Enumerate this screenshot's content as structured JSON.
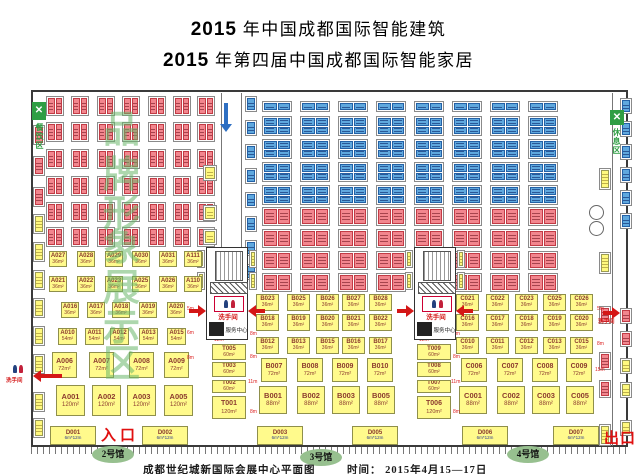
{
  "title": {
    "line1": {
      "num": "2015",
      "text": " 年中国成都国际智能建筑"
    },
    "line2": {
      "num": "2015",
      "text": " 年第四届中国成都国际智能家居"
    }
  },
  "footer": {
    "venue": "成都世纪城新国际会展中心平面图",
    "date": "时间： 2015年4月15—17日"
  },
  "markers": {
    "entrance": "入口",
    "exit": "出口",
    "hall2": "2号馆",
    "hall3": "3号馆",
    "hall4": "4号馆"
  },
  "signs": {
    "restroom": "洗手间",
    "service_center": "服务中心",
    "dining_area": "餐饮区",
    "rest_area": "休息区"
  },
  "watermark_chars": [
    "品",
    "牌",
    "形",
    "象",
    "展",
    "示",
    "区"
  ],
  "colors": {
    "red_booth": "#F2868E",
    "red_border": "#C23B45",
    "blue_booth": "#5FA8DE",
    "blue_border": "#2361A6",
    "yellow_booth": "#FFFA8C",
    "booth_text": "#8B3A2E",
    "hall_oval_green": "#97C08F",
    "arrow_red": "#D41616",
    "arrow_blue": "#2E6FC2",
    "watermark_green": "#69B669",
    "entrance_red": "#E01010"
  },
  "layout": {
    "watermark_ys": [
      112,
      157,
      196,
      230,
      270,
      310,
      346
    ],
    "booth_rows": [
      {
        "y": 251,
        "h": 16,
        "w": 18,
        "size": "36m²",
        "cls": "",
        "items": [
          {
            "id": "A027",
            "x": 49
          },
          {
            "id": "A028",
            "x": 77
          },
          {
            "id": "A029",
            "x": 105
          },
          {
            "id": "A030",
            "x": 132
          },
          {
            "id": "A031",
            "x": 159
          },
          {
            "id": "A111",
            "x": 184
          }
        ]
      },
      {
        "y": 276,
        "h": 16,
        "w": 18,
        "size": "36m²",
        "cls": "",
        "items": [
          {
            "id": "A021",
            "x": 49
          },
          {
            "id": "A022",
            "x": 77
          },
          {
            "id": "A023",
            "x": 105
          },
          {
            "id": "A025",
            "x": 132
          },
          {
            "id": "A026",
            "x": 159
          },
          {
            "id": "A110",
            "x": 184
          }
        ]
      },
      {
        "y": 302,
        "h": 16,
        "w": 18,
        "size": "36m²",
        "cls": "",
        "items": [
          {
            "id": "A016",
            "x": 61
          },
          {
            "id": "A017",
            "x": 87
          },
          {
            "id": "A018",
            "x": 112
          },
          {
            "id": "A019",
            "x": 139
          },
          {
            "id": "A020",
            "x": 167
          }
        ]
      },
      {
        "y": 328,
        "h": 17,
        "w": 19,
        "size": "54m²",
        "cls": "",
        "items": [
          {
            "id": "A010",
            "x": 58
          },
          {
            "id": "A011",
            "x": 85
          },
          {
            "id": "A012",
            "x": 110
          },
          {
            "id": "A013",
            "x": 139
          },
          {
            "id": "A015",
            "x": 167
          }
        ]
      },
      {
        "y": 352,
        "h": 26,
        "w": 25,
        "size": "72m²",
        "cls": "mid",
        "items": [
          {
            "id": "A006",
            "x": 52
          },
          {
            "id": "A007",
            "x": 89
          },
          {
            "id": "A008",
            "x": 129
          },
          {
            "id": "A009",
            "x": 164
          }
        ]
      },
      {
        "y": 385,
        "h": 31,
        "w": 29,
        "size": "120m²",
        "cls": "big",
        "items": [
          {
            "id": "A001",
            "x": 56
          },
          {
            "id": "A002",
            "x": 92
          },
          {
            "id": "A003",
            "x": 127
          },
          {
            "id": "A005",
            "x": 164
          }
        ]
      },
      {
        "y": 294,
        "h": 17,
        "w": 23,
        "size": "36m²",
        "cls": "",
        "items": [
          {
            "id": "B023",
            "x": 256
          },
          {
            "id": "B025",
            "x": 287
          },
          {
            "id": "B026",
            "x": 316
          },
          {
            "id": "B027",
            "x": 342
          },
          {
            "id": "B028",
            "x": 369
          }
        ]
      },
      {
        "y": 314,
        "h": 17,
        "w": 23,
        "size": "36m²",
        "cls": "",
        "items": [
          {
            "id": "B018",
            "x": 256
          },
          {
            "id": "B019",
            "x": 287
          },
          {
            "id": "B020",
            "x": 316
          },
          {
            "id": "B021",
            "x": 342
          },
          {
            "id": "B022",
            "x": 369
          }
        ]
      },
      {
        "y": 337,
        "h": 17,
        "w": 23,
        "size": "36m²",
        "cls": "",
        "items": [
          {
            "id": "B012",
            "x": 256
          },
          {
            "id": "B013",
            "x": 287
          },
          {
            "id": "B015",
            "x": 316
          },
          {
            "id": "B016",
            "x": 342
          },
          {
            "id": "B017",
            "x": 369
          }
        ]
      },
      {
        "y": 358,
        "h": 24,
        "w": 26,
        "size": "72m²",
        "cls": "mid",
        "items": [
          {
            "id": "B007",
            "x": 261
          },
          {
            "id": "B008",
            "x": 297
          },
          {
            "id": "B009",
            "x": 332
          },
          {
            "id": "B010",
            "x": 367
          }
        ]
      },
      {
        "y": 386,
        "h": 28,
        "w": 28,
        "size": "88m²",
        "cls": "big",
        "items": [
          {
            "id": "B001",
            "x": 259
          },
          {
            "id": "B002",
            "x": 297
          },
          {
            "id": "B003",
            "x": 332
          },
          {
            "id": "B005",
            "x": 367
          }
        ]
      },
      {
        "y": 294,
        "h": 17,
        "w": 23,
        "size": "36m²",
        "cls": "",
        "items": [
          {
            "id": "C021",
            "x": 456
          },
          {
            "id": "C022",
            "x": 486
          },
          {
            "id": "C023",
            "x": 515
          },
          {
            "id": "C025",
            "x": 543
          },
          {
            "id": "C026",
            "x": 570
          }
        ]
      },
      {
        "y": 314,
        "h": 17,
        "w": 23,
        "size": "36m²",
        "cls": "",
        "items": [
          {
            "id": "C016",
            "x": 456
          },
          {
            "id": "C017",
            "x": 486
          },
          {
            "id": "C018",
            "x": 515
          },
          {
            "id": "C019",
            "x": 543
          },
          {
            "id": "C020",
            "x": 570
          }
        ]
      },
      {
        "y": 337,
        "h": 17,
        "w": 23,
        "size": "36m²",
        "cls": "",
        "items": [
          {
            "id": "C010",
            "x": 456
          },
          {
            "id": "C011",
            "x": 486
          },
          {
            "id": "C012",
            "x": 515
          },
          {
            "id": "C013",
            "x": 543
          },
          {
            "id": "C015",
            "x": 570
          }
        ]
      },
      {
        "y": 358,
        "h": 24,
        "w": 26,
        "size": "72m²",
        "cls": "mid",
        "items": [
          {
            "id": "C006",
            "x": 461
          },
          {
            "id": "C007",
            "x": 497
          },
          {
            "id": "C008",
            "x": 532
          },
          {
            "id": "C009",
            "x": 566
          }
        ]
      },
      {
        "y": 386,
        "h": 28,
        "w": 28,
        "size": "88m²",
        "cls": "big",
        "items": [
          {
            "id": "C001",
            "x": 459
          },
          {
            "id": "C002",
            "x": 497
          },
          {
            "id": "C003",
            "x": 532
          },
          {
            "id": "C005",
            "x": 566
          }
        ]
      },
      {
        "y": 344,
        "h": 16,
        "w": 34,
        "size": "60m²",
        "cls": "",
        "items": [
          {
            "id": "T005",
            "x": 212
          },
          {
            "id": "T009",
            "x": 417
          }
        ]
      },
      {
        "y": 362,
        "h": 15,
        "w": 34,
        "size": "60m²",
        "cls": "",
        "items": [
          {
            "id": "T003",
            "x": 212
          },
          {
            "id": "T008",
            "x": 417
          }
        ]
      },
      {
        "y": 380,
        "h": 13,
        "w": 34,
        "size": "60m²",
        "cls": "",
        "items": [
          {
            "id": "T002",
            "x": 212
          },
          {
            "id": "T007",
            "x": 417
          }
        ]
      },
      {
        "y": 396,
        "h": 23,
        "w": 34,
        "size": "120m²",
        "cls": "mid",
        "items": [
          {
            "id": "T001",
            "x": 212
          },
          {
            "id": "T006",
            "x": 417
          }
        ]
      },
      {
        "y": 426,
        "h": 19,
        "w": 46,
        "size": "6m*12m",
        "cls": "drow",
        "items": [
          {
            "id": "D001",
            "x": 50
          },
          {
            "id": "D002",
            "x": 142
          },
          {
            "id": "D003",
            "x": 257
          },
          {
            "id": "D005",
            "x": 352
          },
          {
            "id": "D006",
            "x": 462
          },
          {
            "id": "D007",
            "x": 553
          }
        ]
      }
    ],
    "grids": [
      {
        "name": "hall2-red-grid",
        "kind": 2,
        "color": "red",
        "cols": [
          46,
          71,
          97,
          122,
          148,
          173,
          197
        ],
        "rows": [
          96,
          122,
          149,
          176,
          202,
          227
        ],
        "w": 18,
        "h": 20
      },
      {
        "name": "hall34-blue-top-row",
        "kind": 2,
        "color": "blue",
        "cols": [
          262,
          300,
          338,
          376,
          414,
          452,
          490,
          528
        ],
        "rows": [
          101
        ],
        "w": 30,
        "h": 11
      },
      {
        "name": "hall34-blue-blocks",
        "kind": 4,
        "color": "blue",
        "cols": [
          262,
          300,
          338,
          376,
          414,
          452,
          490,
          528
        ],
        "rows": [
          116,
          139,
          162,
          185
        ],
        "w": 30,
        "h": 20
      },
      {
        "name": "hall34-red-rows",
        "kind": 2,
        "color": "red",
        "cols": [
          262,
          300,
          338,
          376,
          414,
          452,
          490,
          528
        ],
        "rows": [
          207,
          229,
          251,
          273
        ],
        "w": 30,
        "h": 19
      },
      {
        "name": "corridor-blue-column",
        "kind": 1,
        "color": "blue",
        "cols": [
          245
        ],
        "rows": [
          96,
          120,
          144,
          168,
          192,
          216,
          240,
          264
        ],
        "w": 12,
        "h": 16
      },
      {
        "name": "corridor-yellow-column",
        "kind": 1,
        "color": "yellow",
        "cols": [
          203
        ],
        "rows": [
          165,
          205,
          229
        ],
        "w": 14,
        "h": 16
      },
      {
        "name": "left-wall-red-column",
        "kind": 1,
        "color": "red",
        "cols": [
          33
        ],
        "rows": [
          125,
          156,
          187
        ],
        "w": 12,
        "h": 20
      },
      {
        "name": "left-wall-yellow-column",
        "kind": 1,
        "color": "yellow",
        "cols": [
          33
        ],
        "rows": [
          214,
          242,
          270,
          298,
          326,
          354,
          392,
          418
        ],
        "w": 12,
        "h": 20
      },
      {
        "name": "facility-side-booths",
        "kind": 1,
        "color": "yellow",
        "cols": [
          197,
          249,
          405,
          457
        ],
        "rows": [
          250,
          272
        ],
        "w": 8,
        "h": 18
      },
      {
        "name": "right-inner-yellow",
        "kind": 1,
        "color": "yellow",
        "cols": [
          599
        ],
        "rows": [
          168,
          252,
          424
        ],
        "w": 12,
        "h": 22
      },
      {
        "name": "right-inner-red",
        "kind": 1,
        "color": "red",
        "cols": [
          599
        ],
        "rows": [
          306,
          352,
          380
        ],
        "w": 12,
        "h": 18
      },
      {
        "name": "right-outer-blue",
        "kind": 1,
        "color": "blue",
        "cols": [
          620
        ],
        "rows": [
          98,
          121,
          144,
          167,
          190,
          213
        ],
        "w": 12,
        "h": 16
      },
      {
        "name": "right-outer-red",
        "kind": 1,
        "color": "red",
        "cols": [
          620
        ],
        "rows": [
          308,
          331
        ],
        "w": 12,
        "h": 16
      },
      {
        "name": "right-outer-yellow",
        "kind": 1,
        "color": "yellow",
        "cols": [
          620
        ],
        "rows": [
          358,
          382,
          420
        ],
        "w": 12,
        "h": 16
      }
    ],
    "facilities": [
      {
        "x": 206,
        "y": 247
      },
      {
        "x": 414,
        "y": 247
      }
    ],
    "arrows": [
      {
        "dir": "down",
        "color": "#2E6FC2",
        "x": 222,
        "y": 103,
        "len": 28
      },
      {
        "dir": "left",
        "color": "#D41616",
        "x": 34,
        "y": 371,
        "len": 28
      },
      {
        "dir": "right",
        "color": "#D41616",
        "x": 189,
        "y": 306,
        "len": 16
      },
      {
        "dir": "left",
        "color": "#D41616",
        "x": 249,
        "y": 306,
        "len": 16
      },
      {
        "dir": "right",
        "color": "#D41616",
        "x": 397,
        "y": 306,
        "len": 16
      },
      {
        "dir": "left",
        "color": "#D41616",
        "x": 457,
        "y": 306,
        "len": 16
      },
      {
        "dir": "right",
        "color": "#D41616",
        "x": 603,
        "y": 308,
        "len": 16
      }
    ],
    "dimensions": [
      {
        "t": "5m",
        "x": 187,
        "y": 307
      },
      {
        "t": "6m",
        "x": 187,
        "y": 331
      },
      {
        "t": "8m",
        "x": 187,
        "y": 356
      },
      {
        "t": "12m",
        "x": 214,
        "y": 338
      },
      {
        "t": "8m",
        "x": 250,
        "y": 332
      },
      {
        "t": "8m",
        "x": 250,
        "y": 355
      },
      {
        "t": "11m",
        "x": 248,
        "y": 380
      },
      {
        "t": "8m",
        "x": 250,
        "y": 410
      },
      {
        "t": "12m",
        "x": 419,
        "y": 338
      },
      {
        "t": "8m",
        "x": 453,
        "y": 332
      },
      {
        "t": "8m",
        "x": 453,
        "y": 355
      },
      {
        "t": "11m",
        "x": 451,
        "y": 380
      },
      {
        "t": "8m",
        "x": 453,
        "y": 410
      },
      {
        "t": "5m",
        "x": 597,
        "y": 307
      },
      {
        "t": "8m",
        "x": 597,
        "y": 342
      },
      {
        "t": "15m",
        "x": 595,
        "y": 368
      }
    ]
  }
}
